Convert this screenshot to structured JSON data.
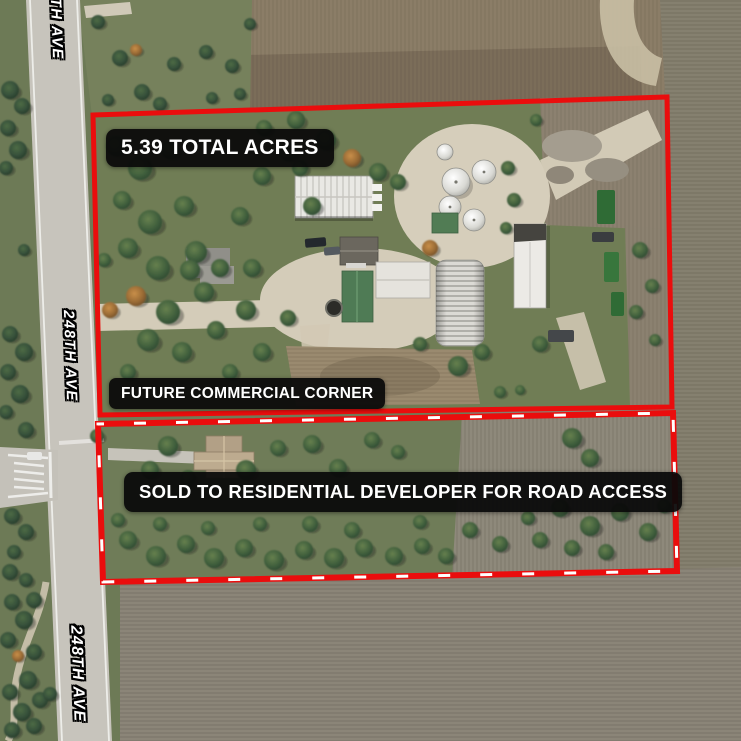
{
  "map": {
    "acres_label": "5.39 TOTAL ACRES",
    "future_label": "FUTURE COMMERCIAL CORNER",
    "sold_label": "SOLD TO RESIDENTIAL DEVELOPER FOR ROAD ACCESS",
    "road_labels": [
      "248TH AVE",
      "248TH AVE",
      "248TH AVE"
    ],
    "colors": {
      "boundary_red": "#ea0d0d",
      "label_bg": "#0a0a0a",
      "label_text": "#ffffff",
      "road_label_text": "#ffffff",
      "road_label_outline": "#000000"
    }
  }
}
